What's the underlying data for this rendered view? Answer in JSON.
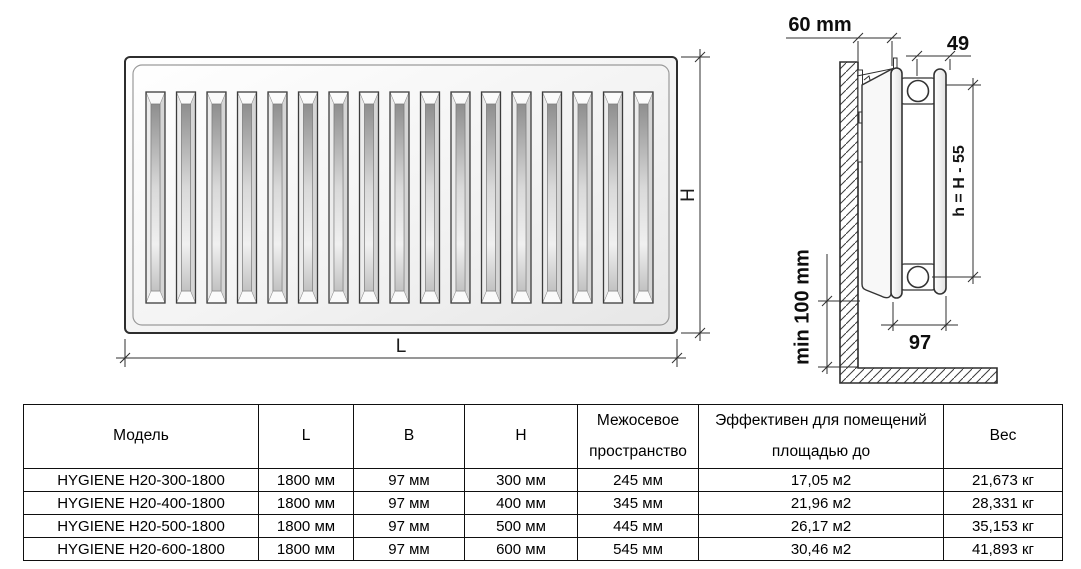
{
  "title": "HYGIENE H20 radiator dimension drawing and specification table",
  "colors": {
    "line": "#2d2d2d",
    "text": "#000000",
    "background": "#ffffff"
  },
  "diagram": {
    "front_view": {
      "slat_count": 17,
      "label_height": "H",
      "label_length": "L"
    },
    "side_view": {
      "label_wall_offset": "60 mm",
      "label_top_width": "49",
      "label_axis_height": "h = H - 55",
      "label_floor_clearance": "min 100 mm",
      "label_depth": "97"
    }
  },
  "table": {
    "headers": [
      "Модель",
      "L",
      "B",
      "H",
      "Межосевое\nпространство",
      "Эффективен для помещений\nплощадью до",
      "Вес"
    ],
    "rows": [
      [
        "HYGIENE H20-300-1800",
        "1800 мм",
        "97 мм",
        "300 мм",
        "245 мм",
        "17,05 м2",
        "21,673 кг"
      ],
      [
        "HYGIENE H20-400-1800",
        "1800 мм",
        "97 мм",
        "400 мм",
        "345 мм",
        "21,96 м2",
        "28,331 кг"
      ],
      [
        "HYGIENE H20-500-1800",
        "1800 мм",
        "97 мм",
        "500 мм",
        "445 мм",
        "26,17 м2",
        "35,153 кг"
      ],
      [
        "HYGIENE H20-600-1800",
        "1800 мм",
        "97 мм",
        "600 мм",
        "545 мм",
        "30,46 м2",
        "41,893 кг"
      ]
    ]
  }
}
